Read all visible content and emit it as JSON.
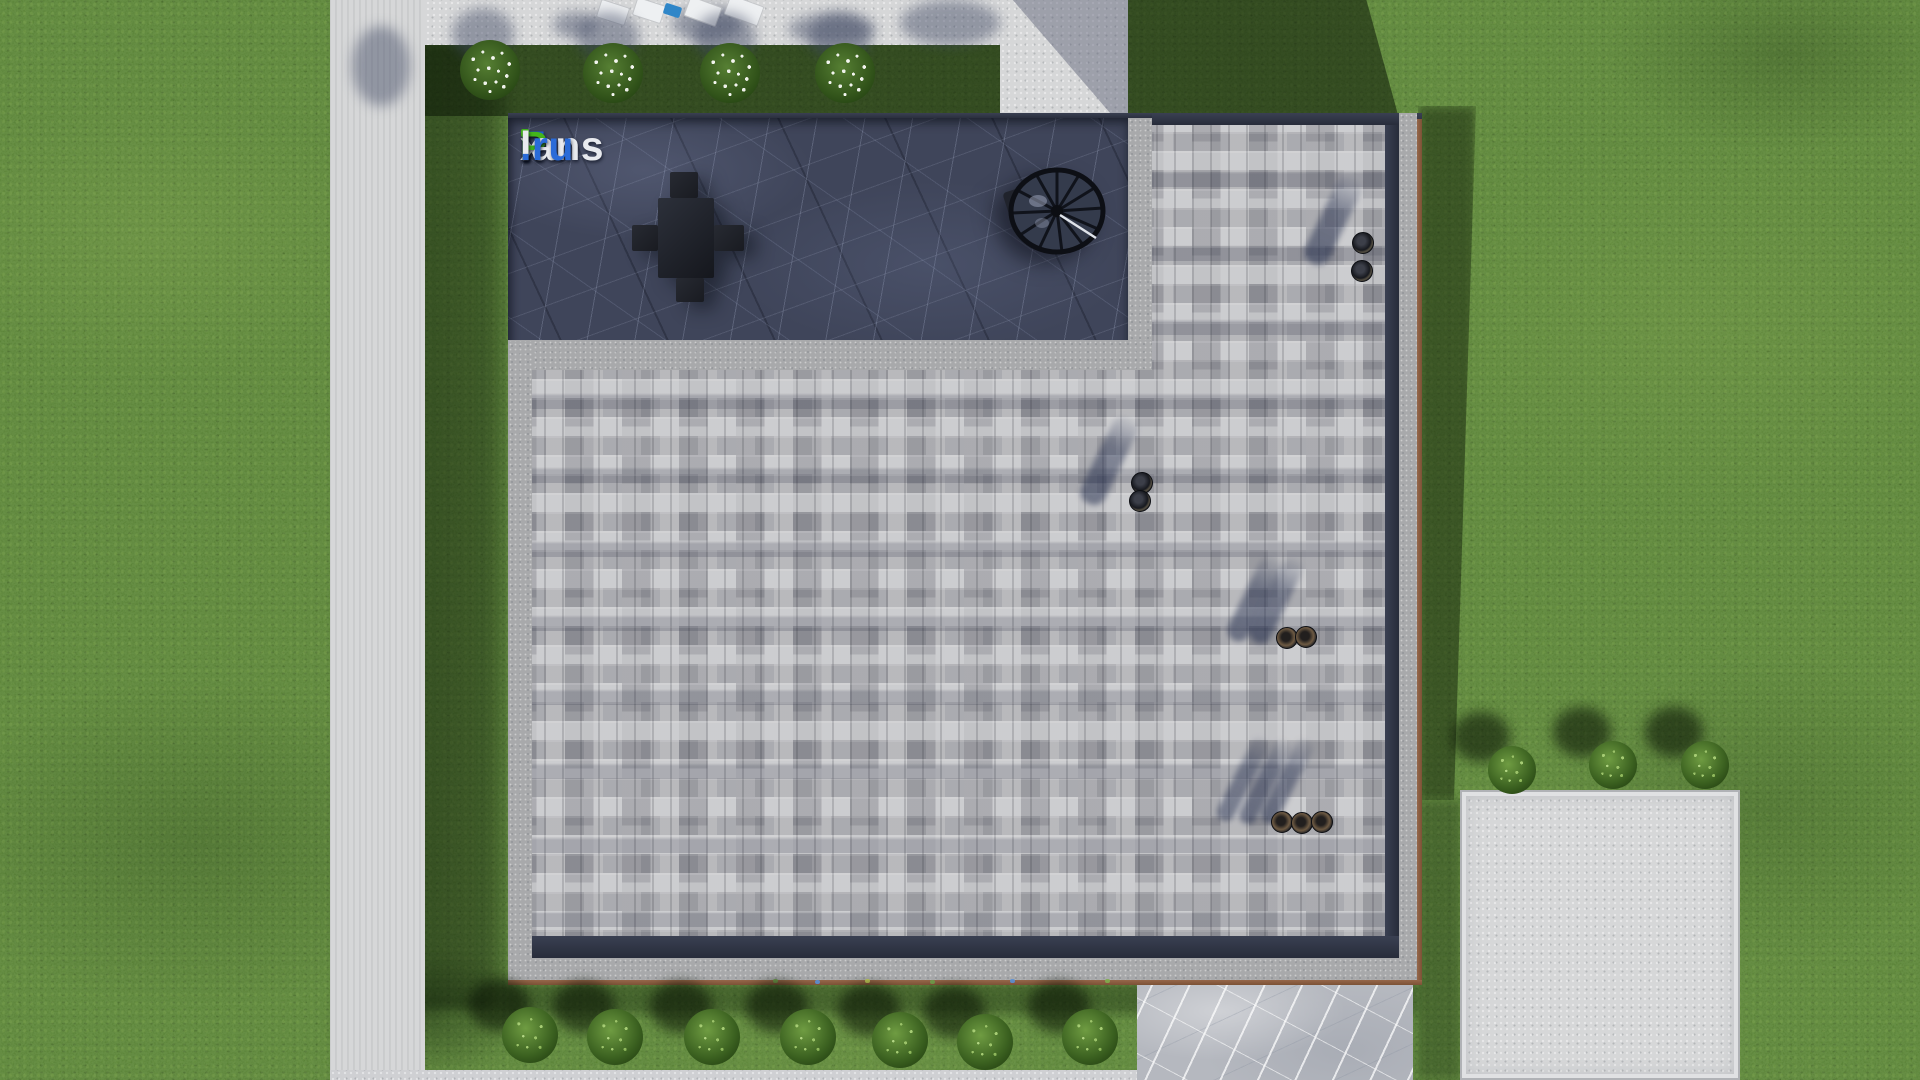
{
  "watermark": {
    "text": "FixPlans.ru",
    "segments": [
      {
        "text": "F",
        "color": "#1d63d8"
      },
      {
        "text": "i",
        "color": "#eef0f4"
      },
      {
        "text": "x",
        "color": "#e8eaee"
      },
      {
        "text": "P",
        "color": "#43b51c"
      },
      {
        "text": "lans",
        "color": "#e8eaee"
      },
      {
        "text": ".ru",
        "color": "#2a6bd8"
      }
    ],
    "i_dot_color": "#43b51c"
  },
  "palette": {
    "grass_sunlit": "#4c7628",
    "grass_shadow": "#22380f",
    "concrete_path": "#d6d7d8",
    "roof_pavers": "#a4a5a9",
    "terrace_marble": "#3f455a",
    "parapet": "#a8a9ab",
    "roof_trim_brown": "#8a5c3e",
    "pad_marble": "#b5b8bf",
    "furniture_dark": "#1f2127",
    "pool_item_blue": "#2f86c8"
  },
  "scene_objects": {
    "flowering_bushes_top": 4,
    "green_bushes_bottom": 7,
    "green_bushes_right": 3,
    "roof_vent_groups": [
      {
        "pipes": 2
      },
      {
        "pipes": 2
      },
      {
        "pipes": 2
      },
      {
        "pipes": 3
      }
    ],
    "terrace_chairs": 4,
    "sun_loungers": 4
  }
}
